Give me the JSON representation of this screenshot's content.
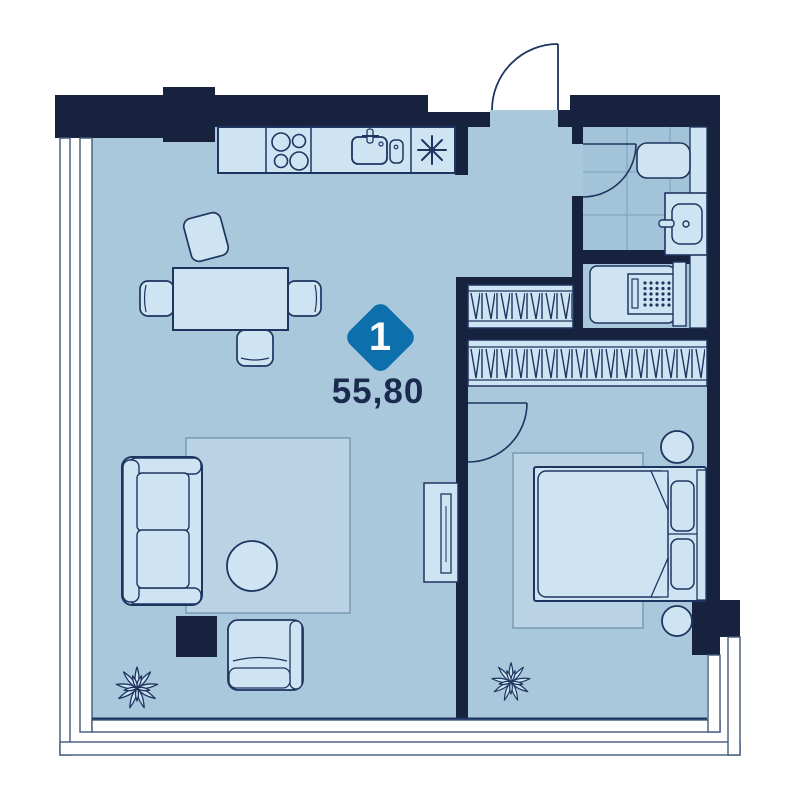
{
  "floorplan": {
    "badge": {
      "number": "1",
      "color": "#0e6fad"
    },
    "area_label": "55,80",
    "colors": {
      "wall": "#17223f",
      "floor": "#a9c8dc",
      "tile": "#a3c3d8",
      "furniture_fill": "#cfe4f3",
      "rug_fill": "#b9d3e4",
      "outline": "#1e3560",
      "accent": "#0e6fad",
      "text": "#1b2b50"
    },
    "icons": [
      "stove-icon",
      "kitchen-sink-icon",
      "fridge-asterisk-icon",
      "toilet-icon",
      "washbasin-icon",
      "washing-machine-icon",
      "wardrobe-hatch-icon",
      "entrance-door",
      "bathroom-door",
      "bedroom-door",
      "plant-icon",
      "bed",
      "sofa",
      "armchair",
      "dining-table",
      "coffee-table",
      "tv-console",
      "nightstand"
    ]
  }
}
